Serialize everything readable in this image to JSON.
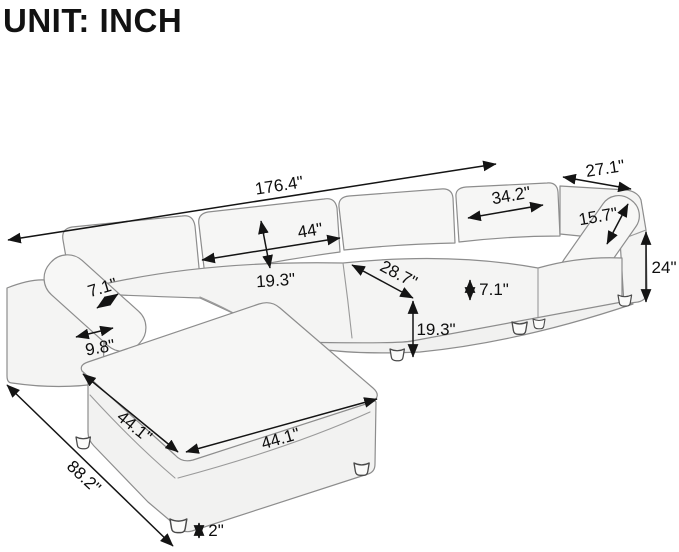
{
  "title": "UNIT: INCH",
  "diagram": {
    "subject": "L-shaped sectional sofa with chaise ottoman, line-art dimension drawing",
    "unit": "inch",
    "dimensions": [
      {
        "id": "overall-length",
        "label": "176.4\""
      },
      {
        "id": "arm-section-depth",
        "label": "27.1\""
      },
      {
        "id": "back-cushion-width",
        "label": "34.2\""
      },
      {
        "id": "back-pillow-height",
        "label": "15.7\""
      },
      {
        "id": "overall-height",
        "label": "24\""
      },
      {
        "id": "seat-cushion-width",
        "label": "44\""
      },
      {
        "id": "seat-cushion-depth",
        "label": "19.3\""
      },
      {
        "id": "corner-seat-diagonal",
        "label": "28.7\""
      },
      {
        "id": "seat-cushion-thickness",
        "label": "7.1\""
      },
      {
        "id": "seat-height",
        "label": "19.3\""
      },
      {
        "id": "arm-pillow-thickness",
        "label": "7.1\""
      },
      {
        "id": "armrest-width",
        "label": "9.8\""
      },
      {
        "id": "chaise-side-length",
        "label": "44.1\""
      },
      {
        "id": "chaise-front-length",
        "label": "44.1\""
      },
      {
        "id": "overall-depth",
        "label": "88.2\""
      },
      {
        "id": "leg-height",
        "label": "2\""
      }
    ]
  }
}
